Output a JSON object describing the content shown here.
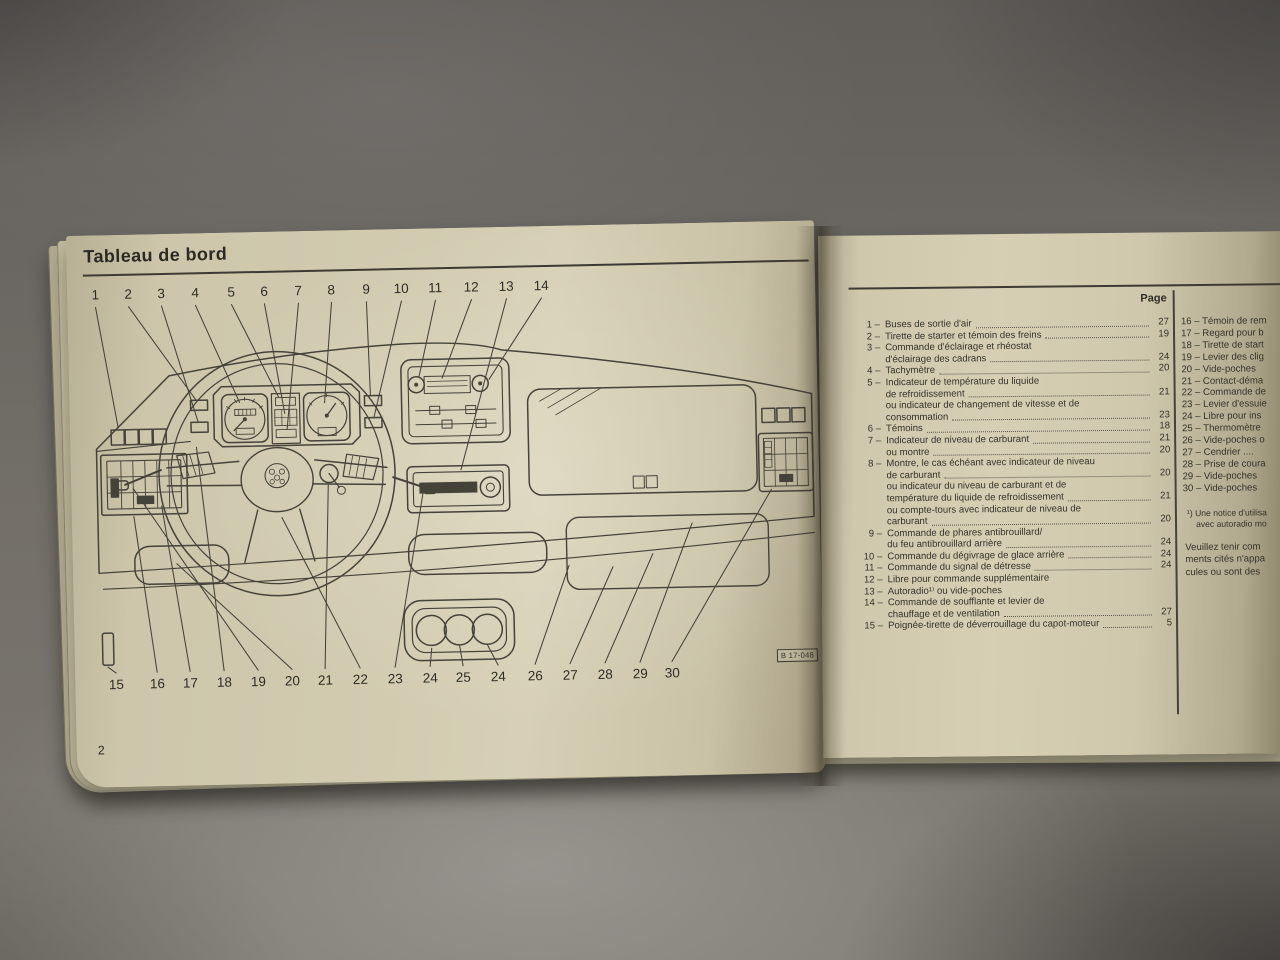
{
  "left_page": {
    "title": "Tableau de bord",
    "page_number": "2",
    "figure_label": "B 17-048",
    "top_callout_numbers": [
      "1",
      "2",
      "3",
      "4",
      "5",
      "6",
      "7",
      "8",
      "9",
      "10",
      "11",
      "12",
      "13",
      "14"
    ],
    "bottom_callout_numbers": [
      "15",
      "16",
      "17",
      "18",
      "19",
      "20",
      "21",
      "22",
      "23",
      "24",
      "25",
      "24",
      "26",
      "27",
      "28",
      "29",
      "30"
    ]
  },
  "right_page": {
    "column_header": "Page",
    "items": [
      {
        "num": "1",
        "lines": [
          {
            "text": "Buses de sortie d'air",
            "page": "27"
          }
        ]
      },
      {
        "num": "2",
        "lines": [
          {
            "text": "Tirette de starter et témoin des freins",
            "page": "19"
          }
        ]
      },
      {
        "num": "3",
        "lines": [
          {
            "text": "Commande d'éclairage et rhéostat"
          },
          {
            "text": "d'éclairage des cadrans",
            "page": "24"
          }
        ]
      },
      {
        "num": "4",
        "lines": [
          {
            "text": "Tachymètre",
            "page": "20"
          }
        ]
      },
      {
        "num": "5",
        "lines": [
          {
            "text": "Indicateur de température du liquide"
          },
          {
            "text": "de refroidissement",
            "page": "21"
          },
          {
            "text": "ou indicateur de changement de vitesse et de"
          },
          {
            "text": "consommation",
            "page": "23"
          }
        ]
      },
      {
        "num": "6",
        "lines": [
          {
            "text": "Témoins",
            "page": "18"
          }
        ]
      },
      {
        "num": "7",
        "lines": [
          {
            "text": "Indicateur de niveau de carburant",
            "page": "21"
          },
          {
            "text": "ou montre",
            "page": "20"
          }
        ]
      },
      {
        "num": "8",
        "lines": [
          {
            "text": "Montre, le cas échéant avec indicateur de niveau"
          },
          {
            "text": "de carburant",
            "page": "20"
          },
          {
            "text": "ou indicateur du niveau de carburant et de"
          },
          {
            "text": "température du liquide de refroidissement",
            "page": "21"
          },
          {
            "text": "ou compte-tours avec indicateur de niveau de"
          },
          {
            "text": "carburant",
            "page": "20"
          }
        ]
      },
      {
        "num": "9",
        "lines": [
          {
            "text": "Commande de phares antibrouillard/"
          },
          {
            "text": "du feu antibrouillard arrière",
            "page": "24"
          }
        ]
      },
      {
        "num": "10",
        "lines": [
          {
            "text": "Commande du dégivrage de glace arrière",
            "page": "24"
          }
        ]
      },
      {
        "num": "11",
        "lines": [
          {
            "text": "Commande du signal de détresse",
            "page": "24"
          }
        ]
      },
      {
        "num": "12",
        "lines": [
          {
            "text": "Libre pour commande supplémentaire"
          }
        ]
      },
      {
        "num": "13",
        "lines": [
          {
            "text": "Autoradio¹⁾ ou vide-poches"
          }
        ]
      },
      {
        "num": "14",
        "lines": [
          {
            "text": "Commande de soufflante et levier de"
          },
          {
            "text": "chauffage et de ventilation",
            "page": "27"
          }
        ]
      },
      {
        "num": "15",
        "lines": [
          {
            "text": "Poignée-tirette de déverrouillage du capot-moteur",
            "page": "5"
          }
        ]
      }
    ],
    "items_right_truncated": [
      {
        "num": "16",
        "text": "Témoin de rem"
      },
      {
        "num": "17",
        "text": "Regard pour b"
      },
      {
        "num": "18",
        "text": "Tirette de start"
      },
      {
        "num": "19",
        "text": "Levier des clig"
      },
      {
        "num": "20",
        "text": "Vide-poches"
      },
      {
        "num": "21",
        "text": "Contact-déma"
      },
      {
        "num": "22",
        "text": "Commande de"
      },
      {
        "num": "23",
        "text": "Levier d'essuie"
      },
      {
        "num": "24",
        "text": "Libre pour ins"
      },
      {
        "num": "25",
        "text": "Thermomètre"
      },
      {
        "num": "26",
        "text": "Vide-poches o"
      },
      {
        "num": "27",
        "text": "Cendrier ...."
      },
      {
        "num": "28",
        "text": "Prise de coura"
      },
      {
        "num": "29",
        "text": "Vide-poches"
      },
      {
        "num": "30",
        "text": "Vide-poches"
      }
    ],
    "footnote_lines": [
      "¹) Une notice d'utilisa",
      "avec autoradio mo"
    ],
    "note_lines": [
      "Veuillez tenir com",
      "ments cités n'appa",
      "cules ou sont des"
    ]
  }
}
